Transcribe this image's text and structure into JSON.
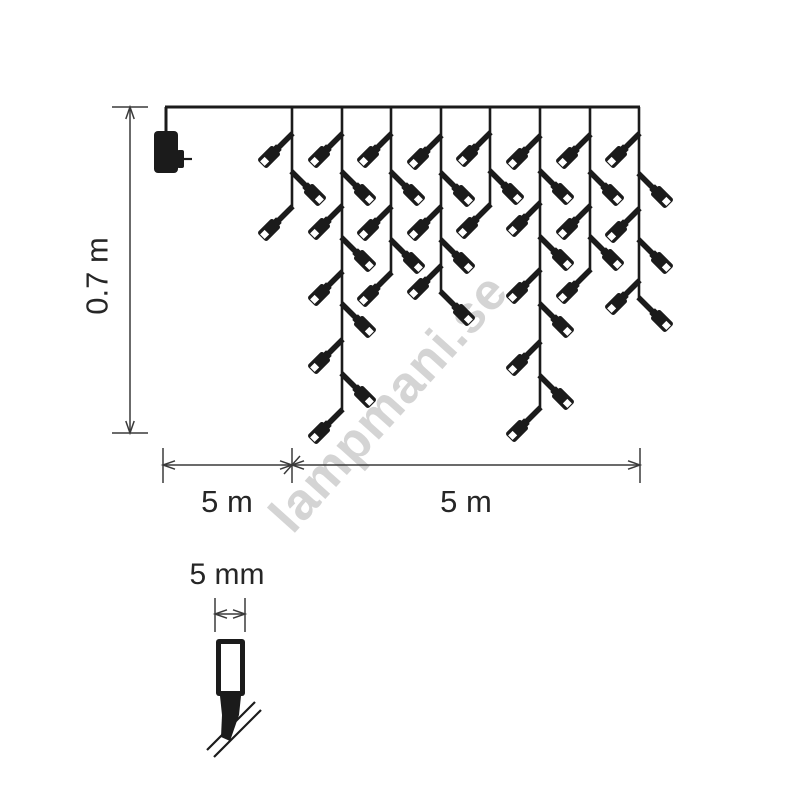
{
  "canvas": {
    "width": 800,
    "height": 800,
    "background": "#ffffff",
    "line_color": "#1b1b1b",
    "dim_color": "#3a3a3a",
    "text_color": "#262626"
  },
  "watermark": {
    "text": "lampmani.se",
    "color": "#d4d4d4",
    "rotation_deg": -48
  },
  "diagram": {
    "top_wire": {
      "x1": 165,
      "x2": 640,
      "y": 107,
      "drop_x": 166,
      "stroke": 3
    },
    "adapter": {
      "x": 154,
      "y": 131,
      "w": 24,
      "h": 42,
      "pin_x": 177,
      "pin_y": 150,
      "pin_w": 7,
      "pin_h": 18,
      "pin_line_x1": 184,
      "pin_line_x2": 192,
      "pin_line_y": 159
    },
    "strands": [
      {
        "x": 292,
        "end": 207,
        "bulbs": [
          {
            "y": 134,
            "side": "L"
          },
          {
            "y": 172,
            "side": "R"
          },
          {
            "y": 207,
            "side": "L"
          }
        ]
      },
      {
        "x": 342,
        "end": 410,
        "bulbs": [
          {
            "y": 134,
            "side": "L"
          },
          {
            "y": 172,
            "side": "R"
          },
          {
            "y": 206,
            "side": "L"
          },
          {
            "y": 238,
            "side": "R"
          },
          {
            "y": 272,
            "side": "L"
          },
          {
            "y": 304,
            "side": "R"
          },
          {
            "y": 340,
            "side": "L"
          },
          {
            "y": 374,
            "side": "R"
          },
          {
            "y": 410,
            "side": "L"
          }
        ]
      },
      {
        "x": 391,
        "end": 273,
        "bulbs": [
          {
            "y": 134,
            "side": "L"
          },
          {
            "y": 172,
            "side": "R"
          },
          {
            "y": 207,
            "side": "L"
          },
          {
            "y": 240,
            "side": "R"
          },
          {
            "y": 273,
            "side": "L"
          }
        ]
      },
      {
        "x": 441,
        "end": 292,
        "bulbs": [
          {
            "y": 136,
            "side": "L"
          },
          {
            "y": 173,
            "side": "R"
          },
          {
            "y": 207,
            "side": "L"
          },
          {
            "y": 240,
            "side": "R"
          },
          {
            "y": 266,
            "side": "L"
          },
          {
            "y": 292,
            "side": "R"
          }
        ]
      },
      {
        "x": 490,
        "end": 205,
        "bulbs": [
          {
            "y": 133,
            "side": "L"
          },
          {
            "y": 171,
            "side": "R"
          },
          {
            "y": 205,
            "side": "L"
          }
        ]
      },
      {
        "x": 540,
        "end": 408,
        "bulbs": [
          {
            "y": 136,
            "side": "L"
          },
          {
            "y": 171,
            "side": "R"
          },
          {
            "y": 203,
            "side": "L"
          },
          {
            "y": 237,
            "side": "R"
          },
          {
            "y": 270,
            "side": "L"
          },
          {
            "y": 304,
            "side": "R"
          },
          {
            "y": 342,
            "side": "L"
          },
          {
            "y": 376,
            "side": "R"
          },
          {
            "y": 408,
            "side": "L"
          }
        ]
      },
      {
        "x": 590,
        "end": 270,
        "bulbs": [
          {
            "y": 135,
            "side": "L"
          },
          {
            "y": 172,
            "side": "R"
          },
          {
            "y": 206,
            "side": "L"
          },
          {
            "y": 237,
            "side": "R"
          },
          {
            "y": 270,
            "side": "L"
          }
        ]
      },
      {
        "x": 639,
        "end": 298,
        "bulbs": [
          {
            "y": 134,
            "side": "L"
          },
          {
            "y": 174,
            "side": "R"
          },
          {
            "y": 209,
            "side": "L"
          },
          {
            "y": 240,
            "side": "R"
          },
          {
            "y": 281,
            "side": "L"
          },
          {
            "y": 298,
            "side": "R"
          }
        ]
      }
    ],
    "dims": {
      "height": {
        "label": "0.7 m",
        "x": 130,
        "y1": 107,
        "y2": 433,
        "cap_x1": 112,
        "cap_x2": 148
      },
      "bottom": {
        "label_left": "5 m",
        "label_right": "5 m",
        "y": 465,
        "x1": 163,
        "xm": 292,
        "x2": 640,
        "ext_y1": 448,
        "ext_y2": 483
      }
    },
    "detail": {
      "label": "5 mm",
      "dim": {
        "x1": 215,
        "x2": 245,
        "y": 614,
        "ext_y1": 598,
        "ext_y2": 632
      },
      "body": {
        "x": 216,
        "y": 639,
        "w": 29,
        "h": 57,
        "border": 5
      },
      "neck": [
        [
          220,
          696
        ],
        [
          241,
          696
        ],
        [
          239,
          715
        ],
        [
          222,
          715
        ]
      ],
      "tip": [
        [
          222,
          715
        ],
        [
          239,
          715
        ],
        [
          230,
          741
        ],
        [
          221,
          737
        ]
      ],
      "wires": [
        [
          207,
          750,
          255,
          702
        ],
        [
          214,
          757,
          261,
          710
        ]
      ],
      "wire_w": 2.2
    }
  }
}
